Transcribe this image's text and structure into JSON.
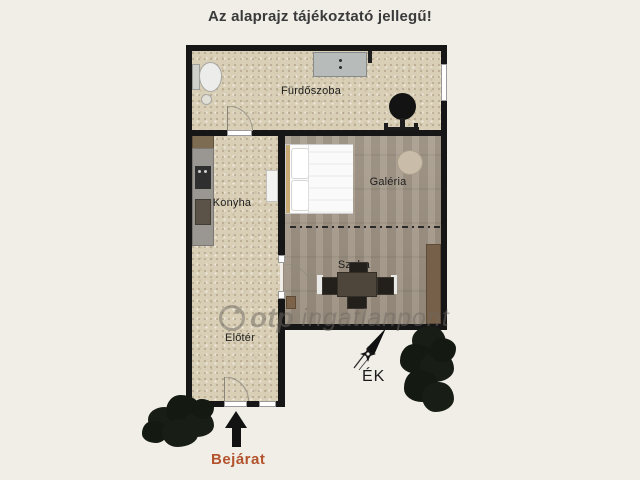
{
  "title": "Az alaprajz tájékoztató jellegű!",
  "floor_plan": {
    "rooms": {
      "bathroom": {
        "label": "Fürdőszoba"
      },
      "kitchen": {
        "label": "Konyha"
      },
      "gallery": {
        "label": "Galéria"
      },
      "living_room": {
        "label": "Szoba"
      },
      "hall": {
        "label": "Előtér"
      }
    },
    "entrance_label": "Bejárat",
    "compass_label": "ÉK"
  },
  "watermark": {
    "brand": "otp",
    "suffix": "ingatlanpont"
  },
  "colors": {
    "background": "#f1eee8",
    "wall": "#161616",
    "tile_floor": "#d9cfb6",
    "wood_floor": "#a49888",
    "entrance_text": "#b2532c",
    "title_text": "#3a3a3a",
    "wardrobe": "#776049",
    "headboard": "#c8a873"
  }
}
